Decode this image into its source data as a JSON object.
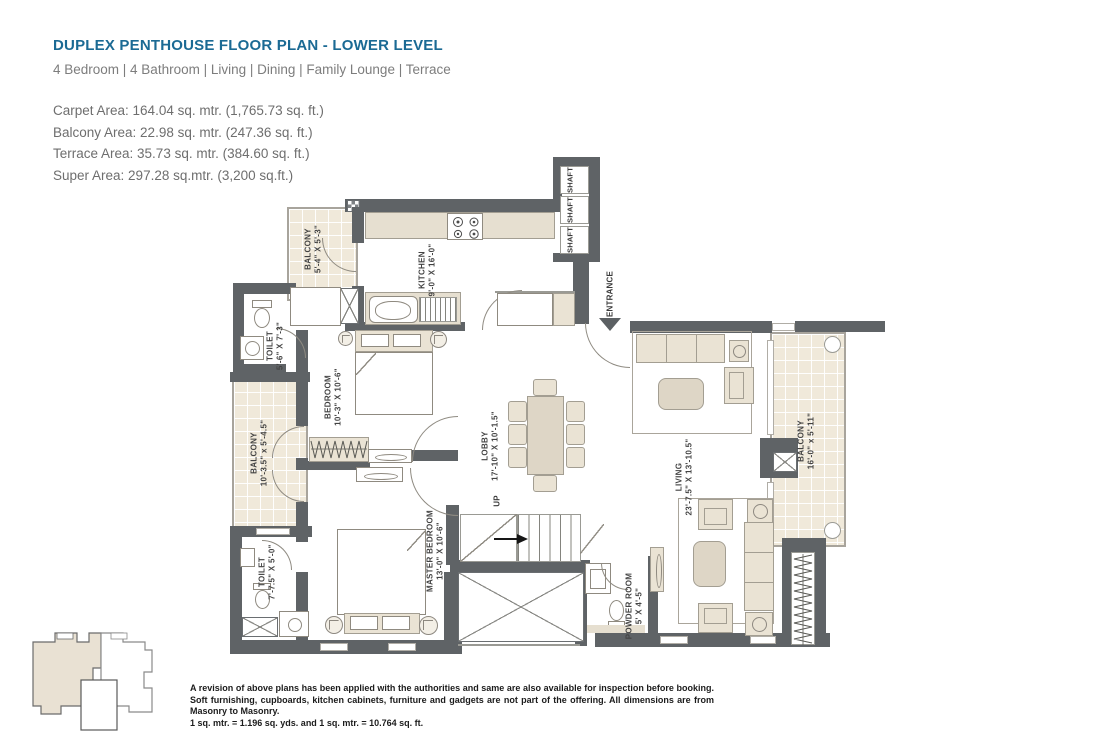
{
  "colors": {
    "accent_title": "#1b6a94",
    "wall": "#5f6366",
    "furniture_fill": "#eae3d4",
    "tile_fill": "#f0e9da"
  },
  "header": {
    "title": "DUPLEX PENTHOUSE FLOOR PLAN - LOWER LEVEL",
    "subtitle": "4 Bedroom  |  4 Bathroom  |  Living  |  Dining  |  Family Lounge  |  Terrace",
    "areas": [
      "Carpet Area: 164.04 sq. mtr. (1,765.73 sq. ft.)",
      "Balcony Area: 22.98 sq. mtr. (247.36 sq. ft.)",
      "Terrace Area: 35.73 sq. mtr. (384.60 sq. ft.)",
      "Super Area: 297.28 sq.mtr. (3,200 sq.ft.)"
    ]
  },
  "plan": {
    "rooms": {
      "balcony_top": {
        "name": "BALCONY",
        "dims": "5'-4\" X 5'-3\""
      },
      "kitchen": {
        "name": "KITCHEN",
        "dims": "9'-0\" X 16'-0\""
      },
      "toilet_top": {
        "name": "TOILET",
        "dims": "5'-6\" X 7'-3\""
      },
      "bedroom": {
        "name": "BEDROOM",
        "dims": "10'-3\" X 10'-6\""
      },
      "balcony_left": {
        "name": "BALCONY",
        "dims": "10'-3.5\" x 5'-4.5\""
      },
      "lobby": {
        "name": "LOBBY",
        "dims": "17'-10\" X 10'-1.5\""
      },
      "living": {
        "name": "LIVING",
        "dims": "23'-7.5\" X 13'-10.5\""
      },
      "balcony_right": {
        "name": "BALCONY",
        "dims": "16'-0\" x 5'-11\""
      },
      "toilet_bottom": {
        "name": "TOILET",
        "dims": "7'-7.5\" X 5'-0\""
      },
      "master_bedroom": {
        "name": "MASTER BEDROOM",
        "dims": "13'-0\" X 10'-6\""
      },
      "powder_room": {
        "name": "POWDER ROOM",
        "dims": "5' X 4'-5\""
      }
    },
    "labels": {
      "entrance": "ENTRANCE",
      "up": "UP",
      "shaft_1": "SHAFT",
      "shaft_2": "SHAFT",
      "shaft_3": "SHAFT"
    }
  },
  "footer": {
    "disclaimer_1": "A revision of above plans has been applied with the authorities and same are also available for inspection before booking. Soft furnishing, cupboards, kitchen cabinets, furniture and gadgets are not part of the offering. All dimensions are from Masonry to Masonry.",
    "disclaimer_2": "1 sq. mtr. = 1.196 sq. yds. and 1 sq. mtr. = 10.764 sq. ft."
  }
}
